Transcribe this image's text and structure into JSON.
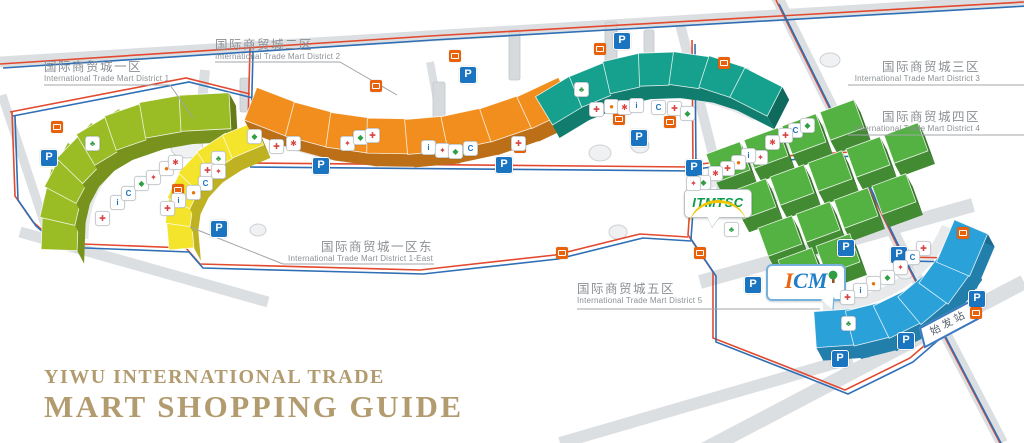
{
  "title": {
    "line1": "YIWU INTERNATIONAL TRADE",
    "line2": "MART SHOPPING GUIDE"
  },
  "districts": [
    {
      "key": "district-1",
      "zh": "国际商贸城一区",
      "en": "International Trade Mart District 1"
    },
    {
      "key": "district-1-east",
      "zh": "国际商贸城一区东",
      "en": "International Trade Mart District 1-East"
    },
    {
      "key": "district-2",
      "zh": "国际商贸城二区",
      "en": "International Trade Mart District 2"
    },
    {
      "key": "district-3",
      "zh": "国际商贸城三区",
      "en": "International Trade Mart District 3"
    },
    {
      "key": "district-4",
      "zh": "国际商贸城四区",
      "en": "International Trade Mart District 4"
    },
    {
      "key": "district-5",
      "zh": "国际商贸城五区",
      "en": "International Trade Mart District 5"
    }
  ],
  "logos": {
    "itmtsc": "ITMTSC",
    "icm_i": "I",
    "icm_cm": "CM"
  },
  "signs": {
    "parking": "P",
    "origin_station": "始发站"
  },
  "map_icons": [
    {
      "name": "first-aid-icon",
      "glyph": "✚",
      "color": "#d84343"
    },
    {
      "name": "info-icon",
      "glyph": "i",
      "color": "#1b75bb"
    },
    {
      "name": "atm-icon",
      "glyph": "C",
      "color": "#1b75bb"
    },
    {
      "name": "escalator-icon",
      "glyph": "◆",
      "color": "#2f9e44"
    },
    {
      "name": "restroom-icon",
      "glyph": "✦",
      "color": "#d84343"
    },
    {
      "name": "food-icon",
      "glyph": "●",
      "color": "#e8720c"
    },
    {
      "name": "medical-icon",
      "glyph": "✱",
      "color": "#d84343"
    },
    {
      "name": "pharmacy-icon",
      "glyph": "♣",
      "color": "#2f9e44"
    }
  ],
  "colors": {
    "district1": "#9abc25",
    "district1_east": "#f4e42b",
    "district2": "#f18e1e",
    "district3": "#16a08e",
    "district4": "#54b242",
    "district5": "#2ba1da",
    "route_a": "#e2492f",
    "route_b": "#2f6fb5",
    "road": "#dcdfe2",
    "parking": "#1a74c0",
    "bus_stop": "#e8620c",
    "title_text": "#b29b6e",
    "label_text": "#8b9094"
  }
}
